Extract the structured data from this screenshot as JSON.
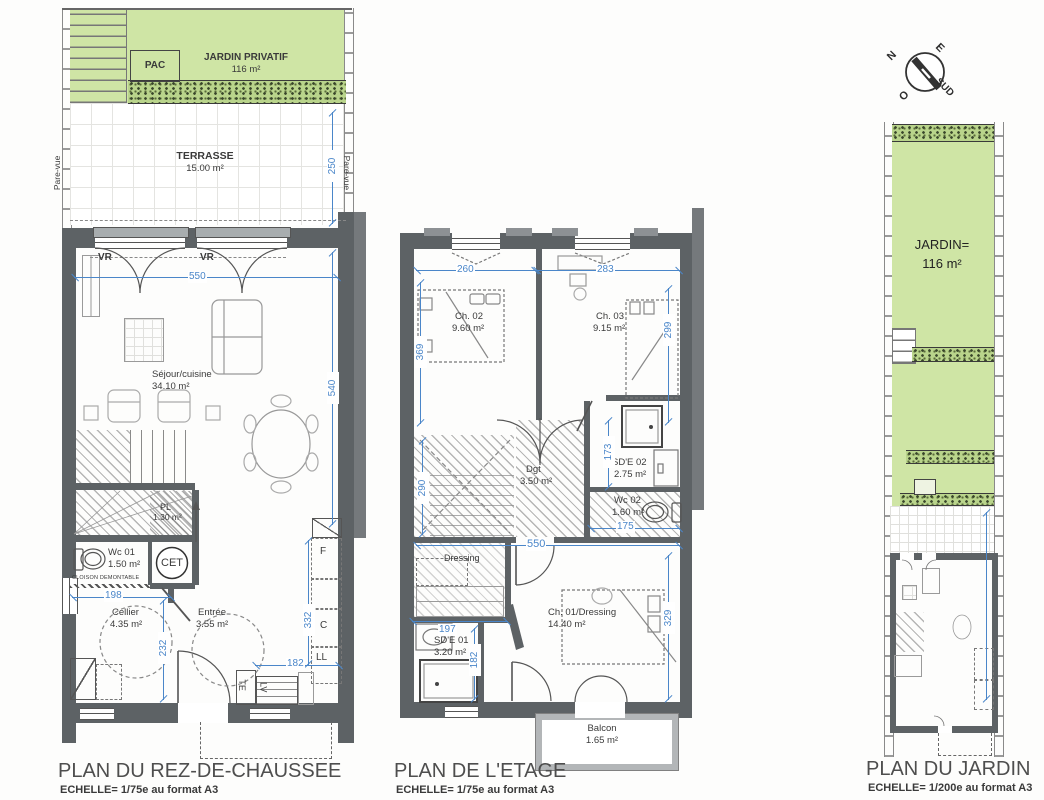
{
  "colors": {
    "green": "#cfe5a5",
    "wall": "#5d6265",
    "dim_blue": "#4a86c9",
    "hedge_dark": "#38452a"
  },
  "gf": {
    "title": "PLAN DU REZ-DE-CHAUSSEE",
    "scale": "ECHELLE= 1/75e au format A3",
    "jardin_label": "JARDIN PRIVATIF",
    "jardin_area": "116 m²",
    "pac": "PAC",
    "terrasse_label": "TERRASSE",
    "terrasse_area": "15.00 m²",
    "pare_vue": "Pare-vue",
    "vr": "VR",
    "sejour_label": "Séjour/cuisine",
    "sejour_area": "34.10 m²",
    "pl_label": "PL",
    "pl_area": "1.30 m²",
    "wc_label": "Wc 01",
    "wc_area": "1.50 m²",
    "cloison": "CLOISON DEMONTABLE",
    "cet": "CET",
    "cellier_label": "Cellier",
    "cellier_area": "4.35 m²",
    "entree_label": "Entrée",
    "entree_area": "3.55 m²",
    "app_f": "F",
    "app_c": "C",
    "app_ll": "LL",
    "app_lv": "LV",
    "app_te": "TE",
    "d250": "250",
    "d550": "550",
    "d540": "540",
    "d198": "198",
    "d232": "232",
    "d332": "332",
    "d182": "182"
  },
  "et": {
    "title": "PLAN DE L'ETAGE",
    "scale": "ECHELLE= 1/75e au format A3",
    "ch02_label": "Ch. 02",
    "ch02_area": "9.60 m²",
    "ch03_label": "Ch. 03",
    "ch03_area": "9.15 m²",
    "dgt_label": "Dgt",
    "dgt_area": "3.50 m²",
    "sde02_label": "SD'E 02",
    "sde02_area": "2.75 m²",
    "wc02_label": "Wc 02",
    "wc02_area": "1.60 m²",
    "dressing_label": "Dressing",
    "sde01_label": "SD'E 01",
    "sde01_area": "3.20 m²",
    "ch01_label": "Ch. 01/Dressing",
    "ch01_area": "14.40 m²",
    "balcon_label": "Balcon",
    "balcon_area": "1.65 m²",
    "d260": "260",
    "d283": "283",
    "d369": "369",
    "d299": "299",
    "d290": "290",
    "d173": "173",
    "d175": "175",
    "d550": "550",
    "d197": "197",
    "d182": "182",
    "d329": "329"
  },
  "jd": {
    "title": "PLAN DU JARDIN",
    "scale": "ECHELLE= 1/200e au format A3",
    "jardin_label": "JARDIN=",
    "jardin_area": "116 m²",
    "compass_n": "N",
    "compass_e": "E",
    "compass_o": "O",
    "compass_sud": "SUD"
  }
}
